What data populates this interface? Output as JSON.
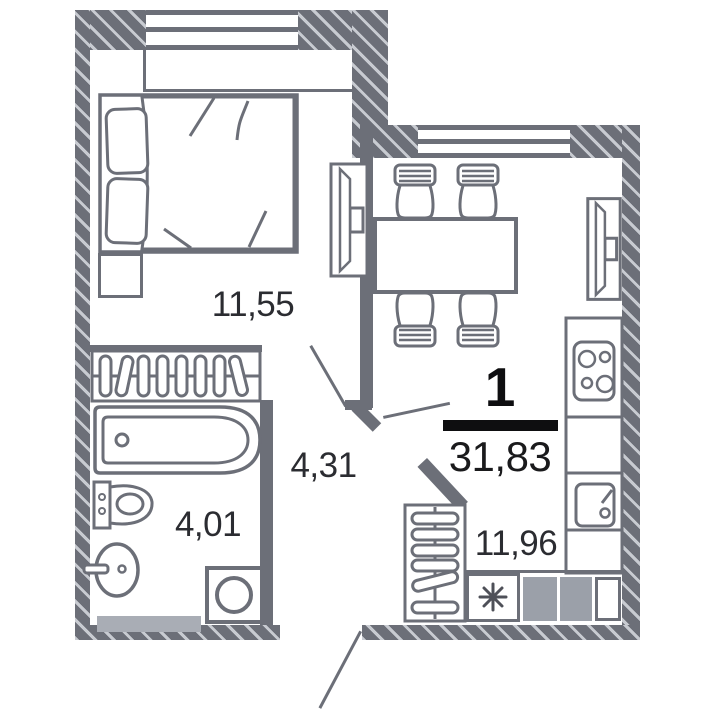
{
  "plan": {
    "unit": {
      "number": "1",
      "total_area": "31,83"
    },
    "rooms": {
      "bedroom": {
        "name": "bedroom",
        "area": "11,55"
      },
      "hallway": {
        "name": "hallway",
        "area": "4,31"
      },
      "bathroom": {
        "name": "bathroom",
        "area": "4,01"
      },
      "kitchen": {
        "name": "kitchen-living",
        "area": "11,96"
      }
    },
    "icons": {
      "appliance_marker": "asterisk",
      "fixtures": [
        "double-bed",
        "nightstand",
        "wardrobe-hangers",
        "bathtub",
        "toilet",
        "washbasin",
        "washing-machine",
        "dining-table",
        "chair",
        "tv",
        "stove-4-burners",
        "kitchen-sink",
        "closet-hangers"
      ]
    },
    "colors": {
      "wall": "#6c6f78",
      "hatch_line": "#c8cbd1",
      "furniture_line": "#6c6f78",
      "label_text": "#2b2c31",
      "unit_text": "#0e0e10",
      "appliance_fill": "#9ba0a9",
      "cabinet_fill": "#a9adb5",
      "background": "#ffffff"
    }
  }
}
